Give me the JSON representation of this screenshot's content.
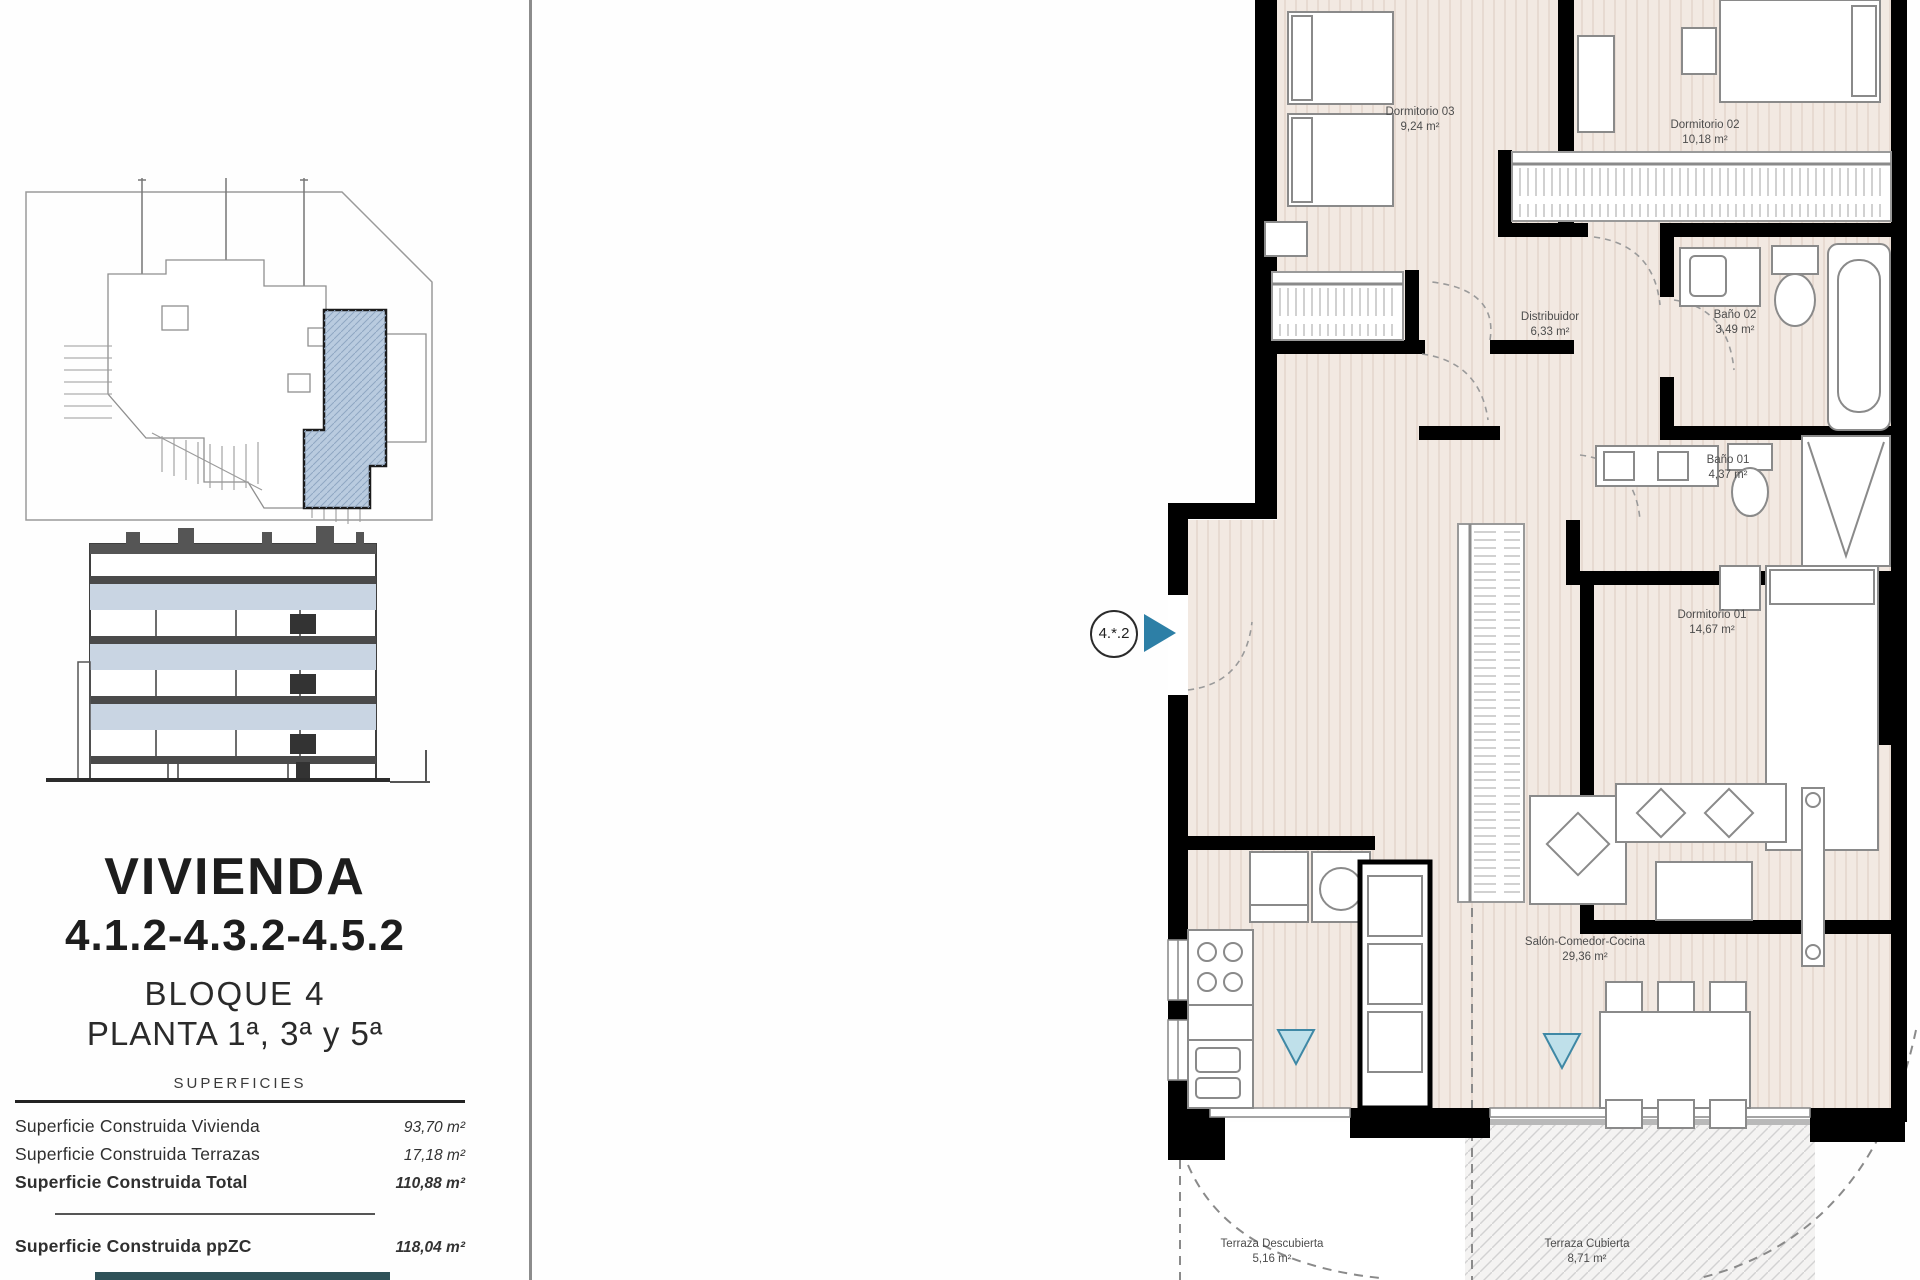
{
  "left_panel": {
    "title": "VIVIENDA",
    "unit_code": "4.1.2-4.3.2-4.5.2",
    "block": "BLOQUE 4",
    "floors": "PLANTA 1ª, 3ª y 5ª",
    "superficies": {
      "header": "SUPERFICIES",
      "rows": [
        {
          "label": "Superficie Construida Vivienda",
          "value": "93,70 m²"
        },
        {
          "label": "Superficie Construida Terrazas",
          "value": "17,18 m²"
        },
        {
          "label": "Superficie Construida Total",
          "value": "110,88 m²"
        },
        {
          "label": "Superficie Construida ppZC",
          "value": "118,04 m²"
        }
      ]
    }
  },
  "floor_plan": {
    "unit_marker": "4.*.2",
    "rooms": [
      {
        "name": "Dormitorio 03",
        "area": "9,24 m²"
      },
      {
        "name": "Dormitorio 02",
        "area": "10,18 m²"
      },
      {
        "name": "Distribuidor",
        "area": "6,33 m²"
      },
      {
        "name": "Baño 02",
        "area": "3,49 m²"
      },
      {
        "name": "Baño 01",
        "area": "4,37 m²"
      },
      {
        "name": "Dormitorio 01",
        "area": "14,67 m²"
      },
      {
        "name": "Salón-Comedor-Cocina",
        "area": "29,36 m²"
      },
      {
        "name": "Terraza Descubierta",
        "area": "5,16 m²"
      },
      {
        "name": "Terraza Cubierta",
        "area": "8,71 m²"
      }
    ]
  },
  "colors": {
    "accent_teal": "#2d7fa6",
    "highlight_blue": "#b9cbdf",
    "elevation_band": "#c9d5e3",
    "floor_tint": "#f2e9e2",
    "wall_black": "#000000",
    "footer_bar": "#2e5158"
  }
}
